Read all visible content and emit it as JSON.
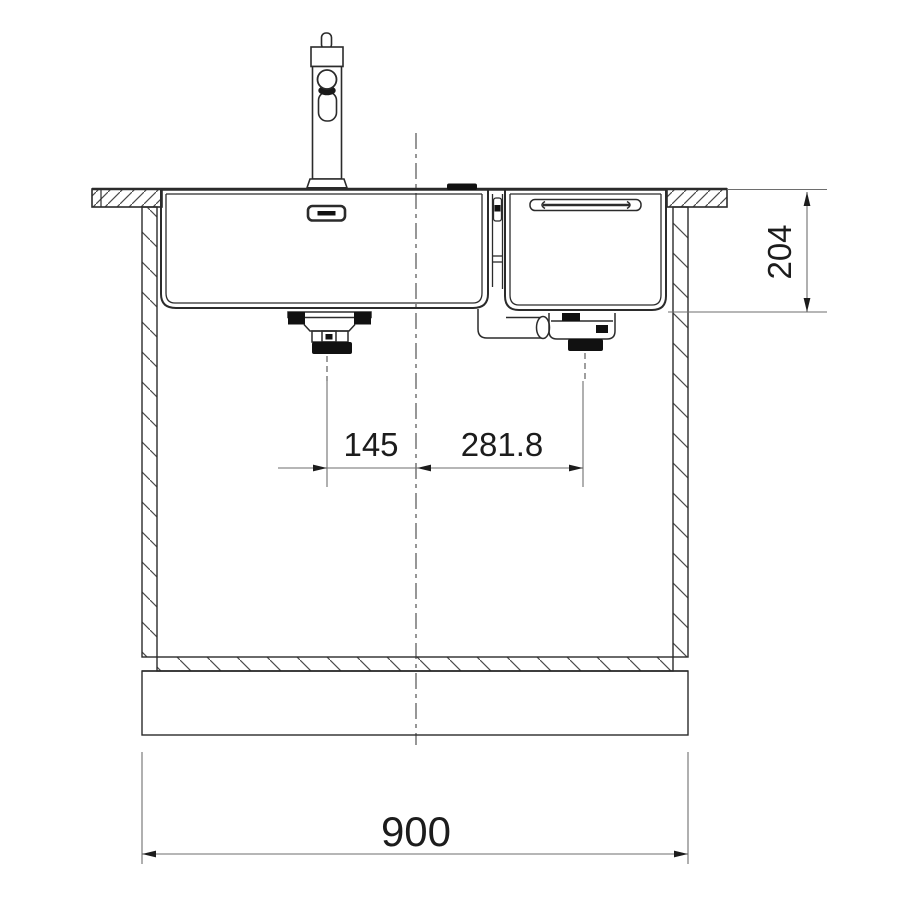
{
  "drawing": {
    "type": "technical-dimension-drawing",
    "subject": "double-bowl undermount kitchen sink with mixer tap, front section view in base cabinet",
    "dimensions": {
      "left_drain_to_center": "145",
      "center_to_right_drain": "281.8",
      "bowl_depth": "204",
      "overall_width": "900"
    },
    "colors": {
      "background": "#ffffff",
      "line": "#2b2b2b",
      "dimension_line": "#6e6e6e",
      "text": "#1c1c1c",
      "fill_black": "#111111"
    }
  }
}
